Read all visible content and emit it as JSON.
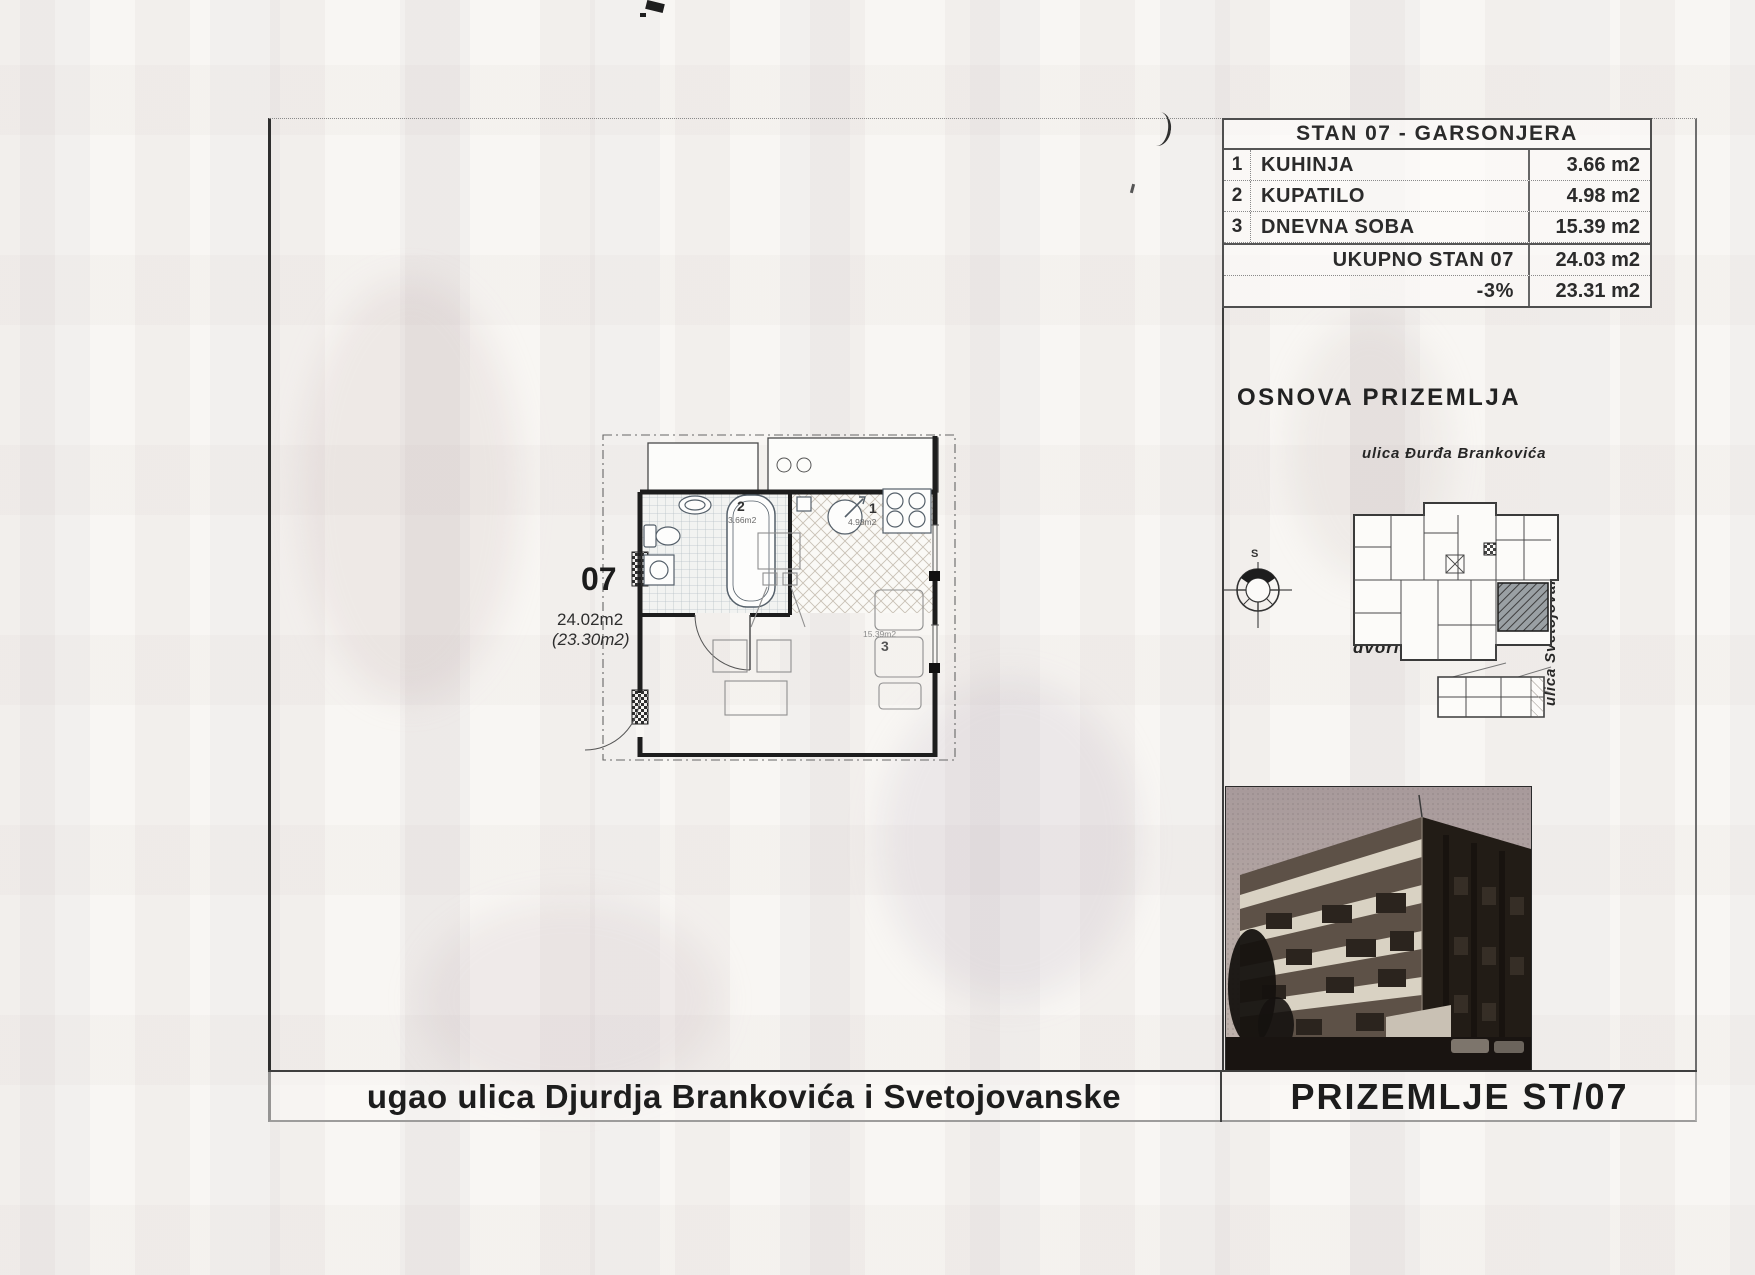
{
  "colors": {
    "ink": "#2b2b2b",
    "paper": "#f8f6f3",
    "photo_sky": "#a89a9b",
    "photo_facade_dark": "#221c16",
    "photo_facade_light": "#5d5147",
    "photo_balcony": "#d9d2c3",
    "highlight_unit_fill": "#8d9194"
  },
  "area_table": {
    "title": "STAN 07 - GARSONJERA",
    "rows": [
      {
        "num": "1",
        "name": "KUHINJA",
        "area": "3.66 m2"
      },
      {
        "num": "2",
        "name": "KUPATILO",
        "area": "4.98 m2"
      },
      {
        "num": "3",
        "name": "DNEVNA SOBA",
        "area": "15.39 m2"
      }
    ],
    "total_label": "UKUPNO STAN 07",
    "total_value": "24.03 m2",
    "discount_label": "-3%",
    "discount_value": "23.31 m2"
  },
  "plan_section": {
    "heading": "OSNOVA PRIZEMLJA",
    "street_top": "ulica Đurđa Brankovića",
    "street_right": "ulica Svetojovanska",
    "courtyard": "dvorište",
    "compass_letter": "S"
  },
  "floor_plan": {
    "unit_number": "07",
    "area_gross": "24.02m2",
    "area_net": "(23.30m2)",
    "rooms": {
      "kitchen": {
        "num": "1",
        "area": "4.98m2"
      },
      "bathroom": {
        "num": "2",
        "area": "3.66m2"
      },
      "living": {
        "num": "3",
        "area": "15.39m2"
      }
    }
  },
  "footer": {
    "left_title": "ugao ulica Djurdja Brankovića i Svetojovanske",
    "right_title": "PRIZEMLJE ST/07"
  }
}
